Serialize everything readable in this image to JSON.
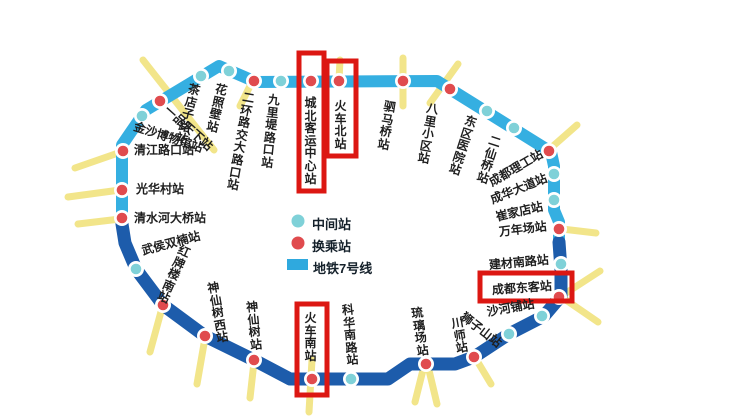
{
  "map": {
    "title": "成都地铁7号线环线示意图",
    "line_name": "地铁7号线"
  },
  "legend": {
    "items": [
      {
        "label": "中间站",
        "type": "intermediate-station",
        "color": "#7fd1d8"
      },
      {
        "label": "换乘站",
        "type": "transfer-station",
        "color": "#e04b4e"
      },
      {
        "label": "地铁7号线",
        "type": "metro-line",
        "color": "#2fa9de"
      }
    ]
  },
  "colors": {
    "line_north_segment": "#35afe1",
    "line_south_segment": "#1d5cab",
    "intermediate_station": "#7fd1d8",
    "transfer_station": "#e04b4e",
    "highlight_box": "#dc1712",
    "transfer_ray": "#f1e27a"
  },
  "stations": [
    {
      "label": "茶店子路站",
      "type": "intermediate",
      "highlighted": false
    },
    {
      "label": "花照壁站",
      "type": "intermediate",
      "highlighted": false
    },
    {
      "label": "二环路交大路口站",
      "type": "transfer",
      "highlighted": false
    },
    {
      "label": "九里堤路口站",
      "type": "intermediate",
      "highlighted": false
    },
    {
      "label": "城北客运中心站",
      "type": "transfer",
      "highlighted": true
    },
    {
      "label": "火车北站",
      "type": "transfer",
      "highlighted": true
    },
    {
      "label": "驷马桥站",
      "type": "transfer",
      "highlighted": false
    },
    {
      "label": "八里小区站",
      "type": "transfer",
      "highlighted": false
    },
    {
      "label": "东区医院站",
      "type": "intermediate",
      "highlighted": false
    },
    {
      "label": "二仙桥站",
      "type": "intermediate",
      "highlighted": false
    },
    {
      "label": "成都理工站",
      "type": "transfer",
      "highlighted": false
    },
    {
      "label": "成华大道站",
      "type": "intermediate",
      "highlighted": false
    },
    {
      "label": "崔家店站",
      "type": "intermediate",
      "highlighted": false
    },
    {
      "label": "万年场站",
      "type": "transfer",
      "highlighted": false
    },
    {
      "label": "建材南路站",
      "type": "intermediate",
      "highlighted": false
    },
    {
      "label": "成都东客站",
      "type": "transfer",
      "highlighted": true
    },
    {
      "label": "沙河铺站",
      "type": "intermediate",
      "highlighted": false
    },
    {
      "label": "狮子山站",
      "type": "intermediate",
      "highlighted": false
    },
    {
      "label": "川师站",
      "type": "transfer",
      "highlighted": false
    },
    {
      "label": "琉璃场站",
      "type": "transfer",
      "highlighted": false
    },
    {
      "label": "科华南路站",
      "type": "intermediate",
      "highlighted": false
    },
    {
      "label": "火车南站",
      "type": "transfer",
      "highlighted": true
    },
    {
      "label": "神仙树站",
      "type": "transfer",
      "highlighted": false
    },
    {
      "label": "神仙树西站",
      "type": "transfer",
      "highlighted": false
    },
    {
      "label": "红牌楼南站",
      "type": "transfer",
      "highlighted": false
    },
    {
      "label": "武侯双楠站",
      "type": "intermediate",
      "highlighted": false
    },
    {
      "label": "清水河大桥站",
      "type": "transfer",
      "highlighted": false
    },
    {
      "label": "光华村站",
      "type": "transfer",
      "highlighted": false
    },
    {
      "label": "清江路口站",
      "type": "transfer",
      "highlighted": false
    },
    {
      "label": "金沙博物馆站",
      "type": "intermediate",
      "highlighted": false
    },
    {
      "label": "一品天下站",
      "type": "transfer",
      "highlighted": false
    }
  ]
}
